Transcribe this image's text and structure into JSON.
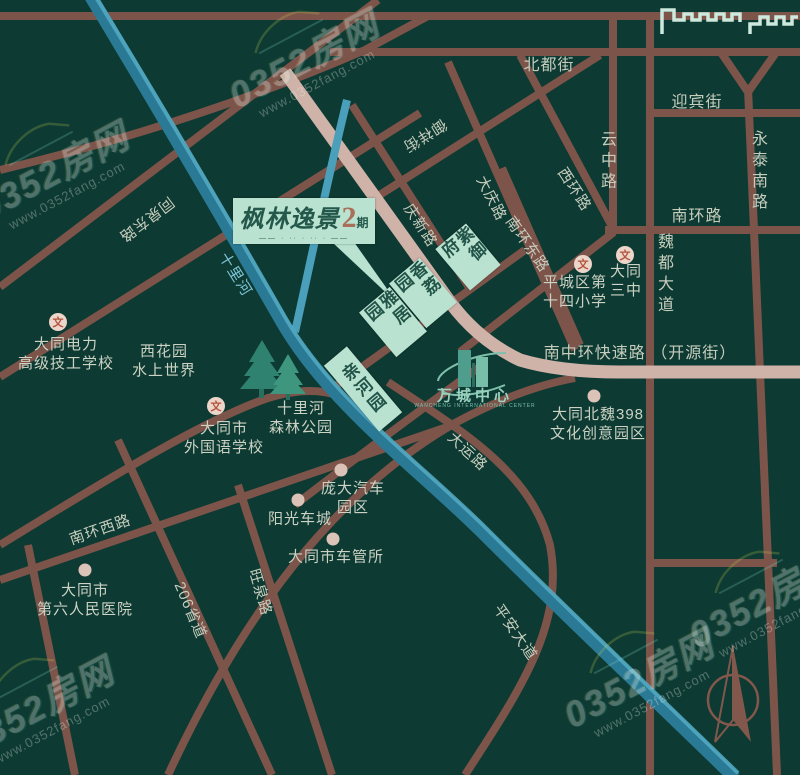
{
  "watermark": {
    "brand": "0352房网",
    "url": "www.0352fang.com"
  },
  "logo": {
    "name": "枫林逸景",
    "phase_number": "2",
    "phase_suffix": "期",
    "tagline": "—— · ·· · ·· · ——"
  },
  "wancheng": {
    "name": "万城中心",
    "subtitle": "WANCHENG INTERNATIONAL CENTER"
  },
  "school_icon_glyph": "文",
  "road_labels": [
    {
      "text": "北都街",
      "x": 549,
      "y": 63,
      "rot": 0,
      "vertical": false,
      "size": 16
    },
    {
      "text": "迎宾街",
      "x": 697,
      "y": 100,
      "rot": 0,
      "vertical": false,
      "size": 16
    },
    {
      "text": "南环路",
      "x": 697,
      "y": 214,
      "rot": 0,
      "vertical": false,
      "size": 16
    },
    {
      "text": "云中路",
      "x": 606,
      "y": 162,
      "rot": 0,
      "vertical": true,
      "size": 16
    },
    {
      "text": "永泰南路",
      "x": 757,
      "y": 172,
      "rot": 0,
      "vertical": true,
      "size": 16
    },
    {
      "text": "魏都大道",
      "x": 663,
      "y": 275,
      "rot": 0,
      "vertical": true,
      "size": 16
    },
    {
      "text": "南中环快速路 （开源街）",
      "x": 640,
      "y": 351,
      "rot": 0,
      "vertical": false,
      "size": 16
    },
    {
      "text": "西环路",
      "x": 575,
      "y": 189,
      "rot": 57,
      "vertical": false,
      "size": 15
    },
    {
      "text": "大庆路",
      "x": 492,
      "y": 198,
      "rot": 63,
      "vertical": false,
      "size": 15
    },
    {
      "text": "庆新路",
      "x": 421,
      "y": 225,
      "rot": 57,
      "vertical": false,
      "size": 15
    },
    {
      "text": "南环东路",
      "x": 528,
      "y": 244,
      "rot": 55,
      "vertical": false,
      "size": 15
    },
    {
      "text": "御祥街",
      "x": 425,
      "y": 136,
      "rot": 148,
      "vertical": false,
      "size": 15
    },
    {
      "text": "同泉东路",
      "x": 147,
      "y": 220,
      "rot": 143,
      "vertical": false,
      "size": 15
    },
    {
      "text": "十里河",
      "x": 236,
      "y": 274,
      "rot": 58,
      "vertical": false,
      "size": 15,
      "color": "#7cc4d6"
    },
    {
      "text": "南环西路",
      "x": 100,
      "y": 529,
      "rot": -19,
      "vertical": false,
      "size": 15
    },
    {
      "text": "206省道",
      "x": 191,
      "y": 610,
      "rot": 67,
      "vertical": false,
      "size": 15
    },
    {
      "text": "旺泉路",
      "x": 261,
      "y": 592,
      "rot": 74,
      "vertical": false,
      "size": 15
    },
    {
      "text": "平安大道",
      "x": 516,
      "y": 632,
      "rot": 55,
      "vertical": false,
      "size": 15
    },
    {
      "text": "大运路",
      "x": 468,
      "y": 451,
      "rot": 43,
      "vertical": false,
      "size": 15
    }
  ],
  "place_labels": [
    {
      "lines": [
        "大同电力",
        "高级技工学校"
      ],
      "x": 66,
      "y": 354
    },
    {
      "lines": [
        "西花园",
        "水上世界"
      ],
      "x": 164,
      "y": 361
    },
    {
      "lines": [
        "十里河",
        "森林公园"
      ],
      "x": 301,
      "y": 418
    },
    {
      "lines": [
        "大同市",
        "外国语学校"
      ],
      "x": 224,
      "y": 438
    },
    {
      "lines": [
        "庞大汽车",
        "园区"
      ],
      "x": 353,
      "y": 498
    },
    {
      "lines": [
        "阳光车城"
      ],
      "x": 300,
      "y": 519
    },
    {
      "lines": [
        "大同市车管所"
      ],
      "x": 336,
      "y": 557
    },
    {
      "lines": [
        "大同市",
        "第六人民医院"
      ],
      "x": 85,
      "y": 600
    },
    {
      "lines": [
        "平城区第",
        "十四小学"
      ],
      "x": 575,
      "y": 292
    },
    {
      "lines": [
        "大同",
        "三中"
      ],
      "x": 626,
      "y": 281
    },
    {
      "lines": [
        "大同北魏398",
        "文化创意园区"
      ],
      "x": 598,
      "y": 424
    }
  ],
  "markers": {
    "school": [
      {
        "x": 58,
        "y": 322
      },
      {
        "x": 216,
        "y": 406
      },
      {
        "x": 583,
        "y": 264
      },
      {
        "x": 625,
        "y": 255
      }
    ],
    "dot": [
      {
        "x": 341,
        "y": 470
      },
      {
        "x": 298,
        "y": 500
      },
      {
        "x": 333,
        "y": 539
      },
      {
        "x": 85,
        "y": 570
      },
      {
        "x": 594,
        "y": 396
      }
    ]
  },
  "estates": [
    {
      "name": "亲河园",
      "x": 363,
      "y": 389,
      "w": 30,
      "h": 86
    },
    {
      "name": "雅居园",
      "x": 393,
      "y": 322,
      "w": 40,
      "h": 58
    },
    {
      "name": "香荔园",
      "x": 423,
      "y": 293,
      "w": 40,
      "h": 58
    },
    {
      "name": "紫御府",
      "x": 468,
      "y": 257,
      "w": 40,
      "h": 54
    }
  ],
  "colors": {
    "background": "#0d3a32",
    "road": "#7d544a",
    "expressway": "#cfb2a8",
    "river": "#2b7a95",
    "river_light": "#55abc4",
    "estate_bg": "#b9e2d1",
    "estate_text": "#235448",
    "label": "#c6cdbd",
    "logo_accent": "#aa6f58"
  }
}
